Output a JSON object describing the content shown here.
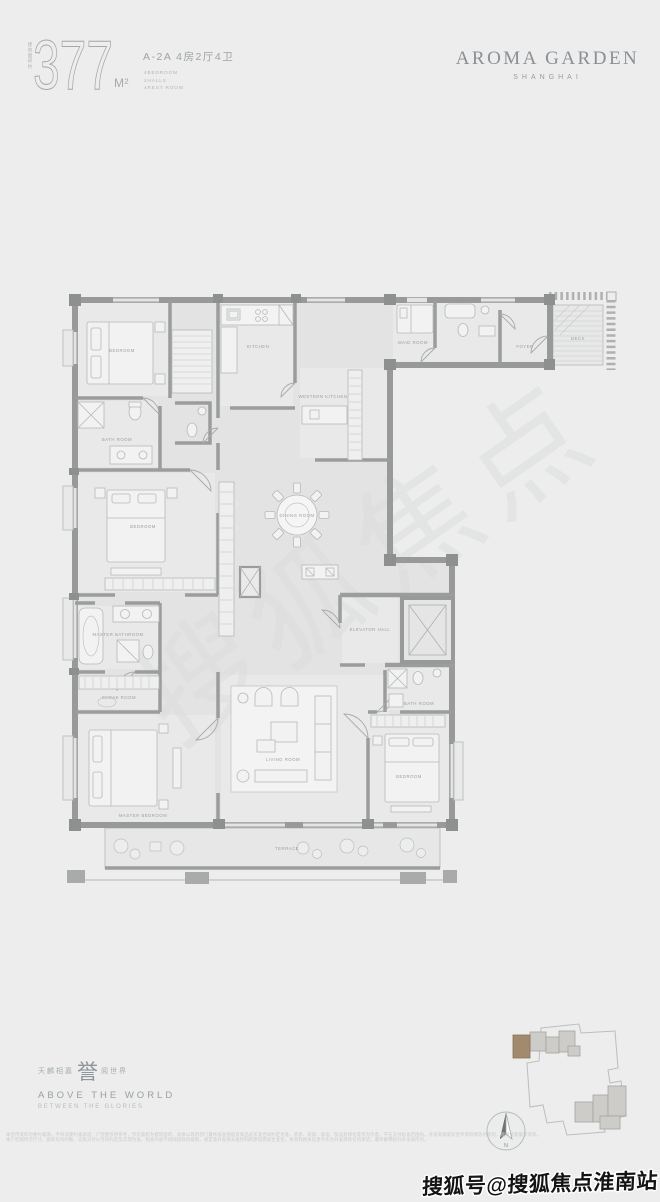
{
  "header": {
    "area_prefix": "建筑面积约",
    "area_value": "377",
    "area_unit": "M²",
    "unit_type": "A-2A 4房2厅4卫",
    "unit_specs": [
      "4BEDROOM",
      "2HALLS",
      "4REST ROOM"
    ],
    "brand": "AROMA GARDEN",
    "brand_sub": "SHANGHAI"
  },
  "floorplan": {
    "rooms": [
      {
        "id": "bedroom-1",
        "label": "BEDROOM"
      },
      {
        "id": "bathroom-1",
        "label": "BATH ROOM"
      },
      {
        "id": "kitchen",
        "label": "KITCHEN"
      },
      {
        "id": "western-kitchen",
        "label": "WESTERN KITCHEN"
      },
      {
        "id": "maid-room",
        "label": "MAID ROOM"
      },
      {
        "id": "foyer",
        "label": "FOYER"
      },
      {
        "id": "deck",
        "label": "DECK"
      },
      {
        "id": "bedroom-2",
        "label": "BEDROOM"
      },
      {
        "id": "dining-room",
        "label": "DINING ROOM"
      },
      {
        "id": "master-bathroom",
        "label": "MASTER BATHROOM"
      },
      {
        "id": "cloak-room",
        "label": "CLOAK ROOM"
      },
      {
        "id": "master-bedroom",
        "label": "MASTER BEDROOM"
      },
      {
        "id": "living-room",
        "label": "LIVING ROOM"
      },
      {
        "id": "elevator-hall",
        "label": "ELEVATOR HALL"
      },
      {
        "id": "bathroom-2",
        "label": "BATH ROOM"
      },
      {
        "id": "bedroom-3",
        "label": "BEDROOM"
      },
      {
        "id": "terrace",
        "label": "TERRACE"
      }
    ]
  },
  "footer": {
    "slogan_cn_left": "天麟相嘉",
    "slogan_cn_big": "誉",
    "slogan_cn_right": "阅世界",
    "slogan_en": "ABOVE THE WORLD",
    "slogan_en_sub": "BETWEEN THE GLORIES",
    "compass_label": "N",
    "disclaimer_line1": "本宣传资料为要约邀请，不构成要约或承诺。户型图仅供参考，所示面积为建筑面积，具体以政府部门最终核准图纸及商品房买卖合同约定为准。装修、家具、家电、陈设及绿化等仅为示意，不在交付标准范围内。开发商保留对宣传资料修改的权利，敬请留意最新资料。",
    "disclaimer_line2": "本户型图所示尺寸、面积均为约数，实际交付以合同约定及实测为准。相关内容不排除因政府规划、规定及开发商未能控制的原因而发生变化，本资料相关信息不作为开发商的任何承诺，最终解释权归开发商所有。"
  },
  "watermark": {
    "diagonal": "搜狐焦点",
    "bottom": "搜狐号@搜狐焦点淮南站"
  },
  "colors": {
    "background": "#ecedec",
    "wall": "#98999a",
    "floor": "#e2e3e2",
    "room_floor": "#e8e9e8",
    "furniture": "#f1f2f1",
    "label": "#9da09f",
    "brand_text": "#8b9094",
    "highlight_unit": "#a28a6e"
  }
}
